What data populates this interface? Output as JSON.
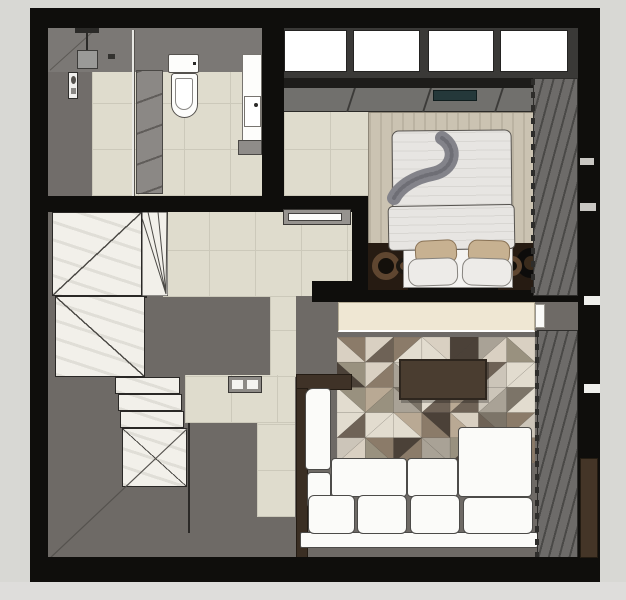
{
  "scene": {
    "type": "floor-plan-render",
    "description": "Top-down 3D rendered apartment floor plan: bathroom top-left, bedroom top-right, stair hall left, living room bottom-right",
    "rooms": [
      "bathroom",
      "bedroom",
      "hall-stairs",
      "living-room"
    ]
  },
  "palette": {
    "wall": "#0f0e0c",
    "bg_outer": "#d8d8d4",
    "bg_outer_bottom": "#dedddb",
    "floor_dark": "#6e6a66",
    "floor_tile": "#dfdccd",
    "grout": "#ccc9ba",
    "marble": "#f2f0ea",
    "marble_edge": "#2a2826",
    "shower": "#716d6a",
    "wall_band": "#7b7875",
    "glass": "#e8e8e4",
    "cabinet": "#8b8885",
    "fixture_white": "#fdfdfb",
    "fixture_edge": "#55524e",
    "window_glass": "#ffffff",
    "window_frame": "#3a3937",
    "sill_dark": "#1d1c1a",
    "sill_gray": "#71706d",
    "ac_teal": "#24383a",
    "bed_rug": "#cbc3b2",
    "duvet": "#e7e5e2",
    "duvet_edge": "#56534f",
    "throw": "#83838a",
    "pillow_tan": "#c7b191",
    "pillow_tan_edge": "#8a7356",
    "pillow_white": "#edebe8",
    "nightstand": "#261b12",
    "ring_brown": "#5f4630",
    "ring_black": "#0d0c0b",
    "curtain": "#6d6b69",
    "curtain_fold": "#4a4947",
    "curtain_edge": "#2e2d2b",
    "console_cream": "#efe7d3",
    "console_brown": "#3f3227",
    "sofa": "#fbfbf9",
    "sofa_edge": "#4c4b49",
    "table": "#4a3d30",
    "table_edge": "#2e261e"
  },
  "bathroom": {
    "fixtures": [
      "rain-shower-head",
      "shower-control-panel",
      "shower-glass-panel",
      "storage-cabinet",
      "wall-hung-toilet",
      "vanity-sink"
    ]
  },
  "bedroom": {
    "window_pane_count": 4,
    "fixtures": [
      "window-band",
      "window-sill-unit",
      "ac-unit",
      "double-bed",
      "throw-blanket",
      "pillows",
      "nightstand-left",
      "nightstand-right",
      "curtain-wall"
    ]
  },
  "hall": {
    "fixtures": [
      "stair-landing",
      "stair-winders",
      "upper-flight",
      "mid-steps",
      "lower-flight",
      "wall-appliance"
    ],
    "stairs": {
      "upper_treads": 7,
      "lower_treads": 4,
      "mid_steps": 3,
      "lower_tread_heights": [
        100,
        84,
        67,
        51
      ]
    }
  },
  "living_room": {
    "fixtures": [
      "tv-console",
      "area-rug",
      "coffee-table",
      "corner-sofa",
      "side-console",
      "curtain-wall"
    ]
  },
  "rug": {
    "cols": 7,
    "rows": 5,
    "seed": 9,
    "palette": [
      "#d9d0c2",
      "#b9a994",
      "#8b7b69",
      "#6e6256",
      "#4b4138",
      "#ccc5b9",
      "#99917f",
      "#a9a296",
      "#e2dccf",
      "#7c7468"
    ]
  },
  "curtains": {
    "angle_deg": 105,
    "stripe_px": 8,
    "gap_px": 2
  }
}
